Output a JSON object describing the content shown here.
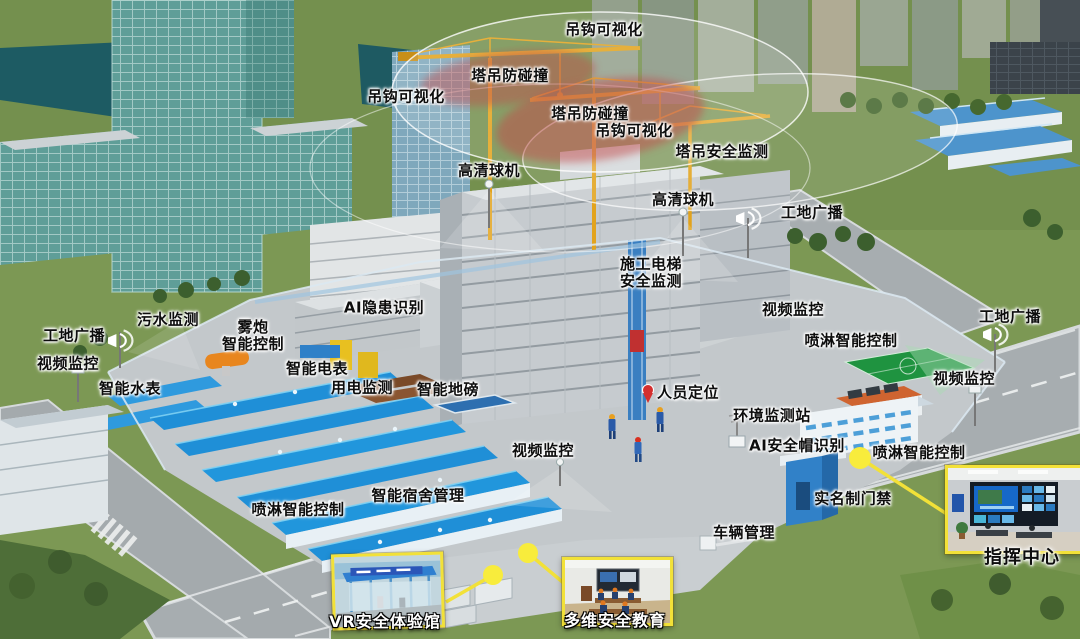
{
  "scene": {
    "name": "智慧工地三维全景示意图",
    "colors": {
      "grass": "#7c9854",
      "road": "#a7adb0",
      "site_concrete": "#c3c8cb",
      "glass_teal": "#5f9e98",
      "water": "#1d5b63",
      "roof_blue": "#1f8fd7",
      "crane_yellow": "#e2a31d",
      "zone_red": "#c24a4a",
      "zone_white": "#ffffff",
      "highlight_yellow": "#f2e138",
      "court_green": "#1f9340"
    }
  },
  "callouts": [
    {
      "id": "hook-visualization-top",
      "text": "吊钩可视化",
      "x": 604,
      "y": 30
    },
    {
      "id": "crane-anti-collision-left",
      "text": "塔吊防碰撞",
      "x": 510,
      "y": 76
    },
    {
      "id": "hook-visualization-left",
      "text": "吊钩可视化",
      "x": 406,
      "y": 97
    },
    {
      "id": "crane-anti-collision-center",
      "text": "塔吊防碰撞",
      "x": 590,
      "y": 114
    },
    {
      "id": "hook-visualization-center",
      "text": "吊钩可视化",
      "x": 634,
      "y": 131
    },
    {
      "id": "tower-crane-safety-monitoring",
      "text": "塔吊安全监测",
      "x": 722,
      "y": 152
    },
    {
      "id": "hd-dome-camera-left",
      "text": "高清球机",
      "x": 489,
      "y": 171
    },
    {
      "id": "hd-dome-camera-right",
      "text": "高清球机",
      "x": 683,
      "y": 200
    },
    {
      "id": "site-broadcast-top-right",
      "text": "工地广播",
      "x": 812,
      "y": 213
    },
    {
      "id": "hoist-safety-monitoring",
      "text": "施工电梯\n安全监测",
      "x": 651,
      "y": 273
    },
    {
      "id": "video-surveillance-mid-right",
      "text": "视频监控",
      "x": 793,
      "y": 310
    },
    {
      "id": "spray-control-right-upper",
      "text": "喷淋智能控制",
      "x": 851,
      "y": 341
    },
    {
      "id": "site-broadcast-far-right",
      "text": "工地广播",
      "x": 1010,
      "y": 317
    },
    {
      "id": "video-surveillance-far-right",
      "text": "视频监控",
      "x": 964,
      "y": 379
    },
    {
      "id": "sewage-monitoring",
      "text": "污水监测",
      "x": 168,
      "y": 320
    },
    {
      "id": "fog-cannon-control",
      "text": "雾炮\n智能控制",
      "x": 253,
      "y": 336
    },
    {
      "id": "site-broadcast-left",
      "text": "工地广播",
      "x": 74,
      "y": 336
    },
    {
      "id": "video-surveillance-left",
      "text": "视频监控",
      "x": 68,
      "y": 364
    },
    {
      "id": "smart-water-meter",
      "text": "智能水表",
      "x": 130,
      "y": 389
    },
    {
      "id": "ai-hazard-identification",
      "text": "AI隐患识别",
      "x": 384,
      "y": 308
    },
    {
      "id": "smart-electric-meter",
      "text": "智能电表",
      "x": 317,
      "y": 369
    },
    {
      "id": "power-monitoring",
      "text": "用电监测",
      "x": 362,
      "y": 388
    },
    {
      "id": "smart-weighbridge",
      "text": "智能地磅",
      "x": 448,
      "y": 390
    },
    {
      "id": "personnel-positioning",
      "text": "人员定位",
      "x": 688,
      "y": 393
    },
    {
      "id": "environment-monitoring-station",
      "text": "环境监测站",
      "x": 772,
      "y": 416
    },
    {
      "id": "ai-helmet-recognition",
      "text": "AI安全帽识别",
      "x": 797,
      "y": 446
    },
    {
      "id": "video-surveillance-center",
      "text": "视频监控",
      "x": 543,
      "y": 451
    },
    {
      "id": "spray-control-right-lower",
      "text": "喷淋智能控制",
      "x": 919,
      "y": 453
    },
    {
      "id": "smart-dormitory-management",
      "text": "智能宿舍管理",
      "x": 418,
      "y": 496
    },
    {
      "id": "spray-control-left",
      "text": "喷淋智能控制",
      "x": 298,
      "y": 510
    },
    {
      "id": "real-name-access-control",
      "text": "实名制门禁",
      "x": 853,
      "y": 499
    },
    {
      "id": "vehicle-management",
      "text": "车辆管理",
      "x": 744,
      "y": 533
    }
  ],
  "insets": {
    "vr": {
      "label": "VR安全体验馆"
    },
    "edu": {
      "label": "多维安全教育"
    },
    "command": {
      "label": "指挥中心"
    }
  }
}
